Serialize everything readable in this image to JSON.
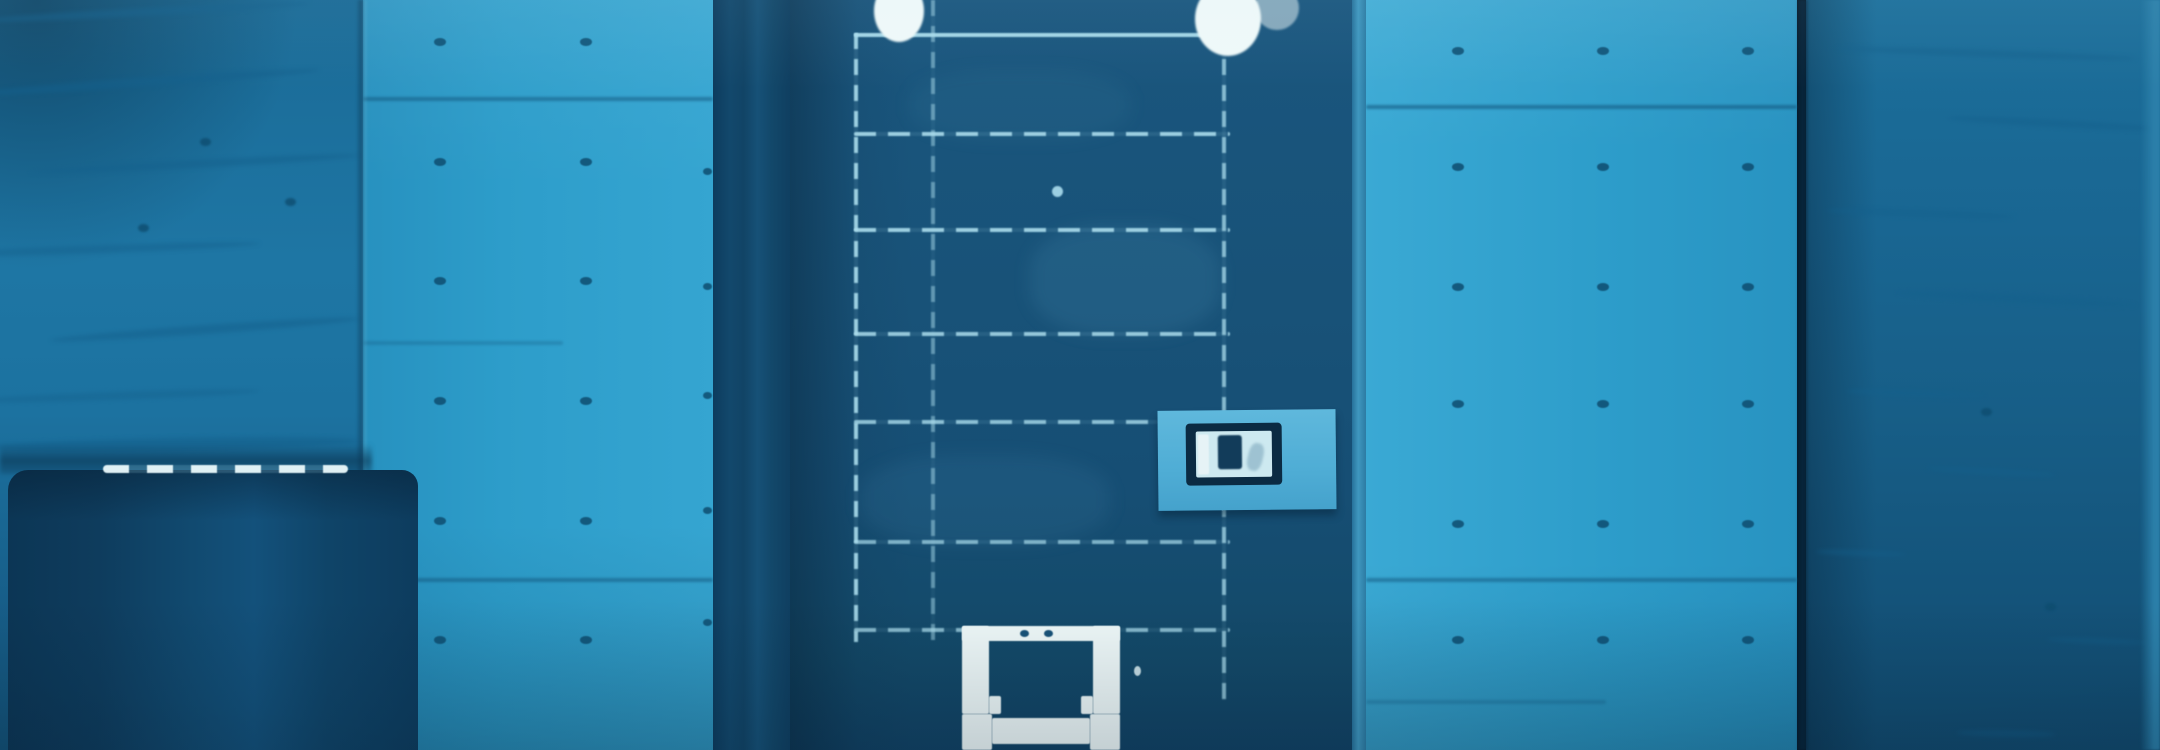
{
  "meta": {
    "description": "Blue-tinted photograph of a dark metal cell door recessed between bare concrete walls; white food hatch at the bottom of the door, small light-blue name plate on the right side of the door, dark covered bin at lower left, concrete form-tie holes on the flanking walls."
  },
  "palette": {
    "light_wall": "#2d9dca",
    "light_wall_bright": "#3aa9d4",
    "left_wall_top": "#1a6a96",
    "left_wall_mid": "#1e76a4",
    "left_wall_bot": "#135278",
    "right_wall_top": "#1c6f9b",
    "right_wall_bot": "#114a6e",
    "sliver": "#2b7fa9",
    "wall_streak": "#14608c",
    "joint": "#13587f",
    "tie_hole": "#0e4d70",
    "door_top": "#1a567e",
    "door_mid": "#185278",
    "door_bot": "#114264",
    "door_line": "#aadcec",
    "door_edge": "#3f97bf",
    "peephole": "#9ccfe2",
    "white": "#eff9f9",
    "sign_plate": "#5fb8dc",
    "sign_frame": "#0b2b43",
    "sign_card": "#cde9f0",
    "sign_glyph": "#123c5a",
    "bin_dark": "#0c3655",
    "bin_mid": "#114a70"
  },
  "scene": {
    "left_textured_wall": {
      "streaks": [
        {
          "x": -20,
          "y": 8,
          "w": 330,
          "h": 8,
          "r": -3,
          "o": 0.5
        },
        {
          "x": -40,
          "y": 78,
          "w": 360,
          "h": 9,
          "r": -4,
          "o": 0.55
        },
        {
          "x": 30,
          "y": 160,
          "w": 330,
          "h": 8,
          "r": -3,
          "o": 0.5
        },
        {
          "x": -50,
          "y": 245,
          "w": 310,
          "h": 8,
          "r": -2,
          "o": 0.45
        },
        {
          "x": 50,
          "y": 325,
          "w": 310,
          "h": 9,
          "r": -4,
          "o": 0.5
        },
        {
          "x": -30,
          "y": 392,
          "w": 290,
          "h": 8,
          "r": -2,
          "o": 0.4
        },
        {
          "x": -10,
          "y": 438,
          "w": 370,
          "h": 12,
          "r": -1,
          "o": 0.55
        }
      ],
      "dots": [
        {
          "x": 200,
          "y": 138
        },
        {
          "x": 285,
          "y": 198
        },
        {
          "x": 138,
          "y": 224
        }
      ]
    },
    "left_light_wall": {
      "tie_holes": {
        "columns": [
          71,
          217
        ],
        "rows": [
          38,
          158,
          277,
          397,
          517,
          636
        ],
        "edge_column": {
          "x": 340,
          "rows": [
            168,
            283,
            392,
            507,
            619
          ]
        }
      },
      "joints": [
        {
          "x": 0,
          "y": 97,
          "w": 350,
          "o": 0.55
        },
        {
          "x": 0,
          "y": 341,
          "w": 200,
          "o": 0.3
        },
        {
          "x": 0,
          "y": 578,
          "w": 350,
          "o": 0.55
        }
      ]
    },
    "right_light_wall": {
      "tie_holes": {
        "columns": [
          86,
          231,
          376
        ],
        "rows": [
          47,
          163,
          283,
          400,
          520,
          636
        ]
      },
      "joints": [
        {
          "x": 0,
          "y": 105,
          "w": 431,
          "o": 0.6
        },
        {
          "x": 0,
          "y": 578,
          "w": 431,
          "o": 0.55
        },
        {
          "x": 0,
          "y": 700,
          "w": 240,
          "o": 0.3
        }
      ]
    },
    "right_textured_wall": {
      "streaks": [
        {
          "x": 30,
          "y": 50,
          "w": 300,
          "h": 7,
          "r": 2,
          "o": 0.5
        },
        {
          "x": 140,
          "y": 120,
          "w": 220,
          "h": 7,
          "r": 3,
          "o": 0.5
        },
        {
          "x": 20,
          "y": 210,
          "w": 190,
          "h": 7,
          "r": 2,
          "o": 0.45
        },
        {
          "x": 90,
          "y": 295,
          "w": 240,
          "h": 8,
          "r": 3,
          "o": 0.5
        },
        {
          "x": 40,
          "y": 390,
          "w": 140,
          "h": 7,
          "r": 2,
          "o": 0.45
        },
        {
          "x": 120,
          "y": 468,
          "w": 130,
          "h": 7,
          "r": 3,
          "o": 0.4
        },
        {
          "x": 10,
          "y": 550,
          "w": 90,
          "h": 6,
          "r": 2,
          "o": 0.4
        },
        {
          "x": 240,
          "y": 638,
          "w": 100,
          "h": 6,
          "r": 2,
          "o": 0.35
        },
        {
          "x": 150,
          "y": 730,
          "w": 100,
          "h": 7,
          "r": 1,
          "o": 0.35
        }
      ],
      "dots": [
        {
          "x": 239,
          "y": 603
        },
        {
          "x": 175,
          "y": 408
        }
      ]
    },
    "door": {
      "h_lines": [
        {
          "y": 33,
          "x1": 64,
          "x2": 440,
          "o": 0.95,
          "solid": true
        },
        {
          "y": 132,
          "x1": 64,
          "x2": 440,
          "o": 0.9
        },
        {
          "y": 228,
          "x1": 64,
          "x2": 440,
          "o": 0.9
        },
        {
          "y": 332,
          "x1": 64,
          "x2": 440,
          "o": 0.85
        },
        {
          "y": 420,
          "x1": 64,
          "x2": 368,
          "o": 0.8
        },
        {
          "y": 540,
          "x1": 64,
          "x2": 440,
          "o": 0.7
        },
        {
          "y": 628,
          "x1": 64,
          "x2": 440,
          "o": 0.75
        }
      ],
      "v_lines": [
        {
          "x": 64,
          "y1": 33,
          "y2": 642,
          "o": 0.9
        },
        {
          "x": 141,
          "y1": 0,
          "y2": 640,
          "o": 0.5
        },
        {
          "x": 432,
          "y1": 33,
          "y2": 700,
          "o": 0.75
        }
      ],
      "peephole": {
        "x": 262,
        "y": 186
      },
      "top_blobs": [
        {
          "cx": 109,
          "top": -20,
          "w": 50,
          "h": 62,
          "o": 1
        },
        {
          "cx": 438,
          "top": -18,
          "w": 66,
          "h": 74,
          "o": 1
        },
        {
          "cx": 487,
          "top": -14,
          "w": 44,
          "h": 44,
          "o": 0.5
        }
      ]
    }
  }
}
